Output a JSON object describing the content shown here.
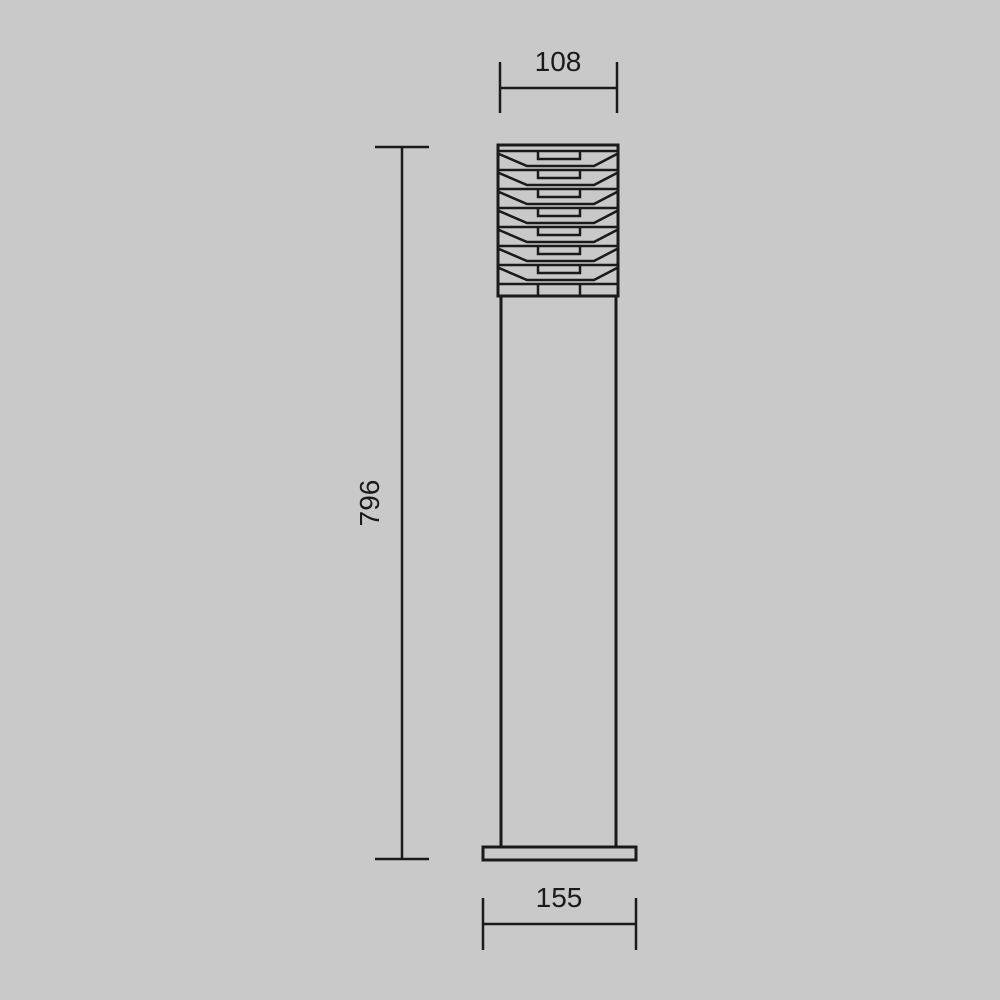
{
  "page": {
    "background_color": "#c9c9c9",
    "line_color": "#1a1a1a"
  },
  "drawing": {
    "type": "technical dimension drawing",
    "subject": "outdoor bollard light with louvered head, front elevation",
    "dimensions": {
      "head_width": "108",
      "overall_height": "796",
      "base_width": "155"
    }
  }
}
